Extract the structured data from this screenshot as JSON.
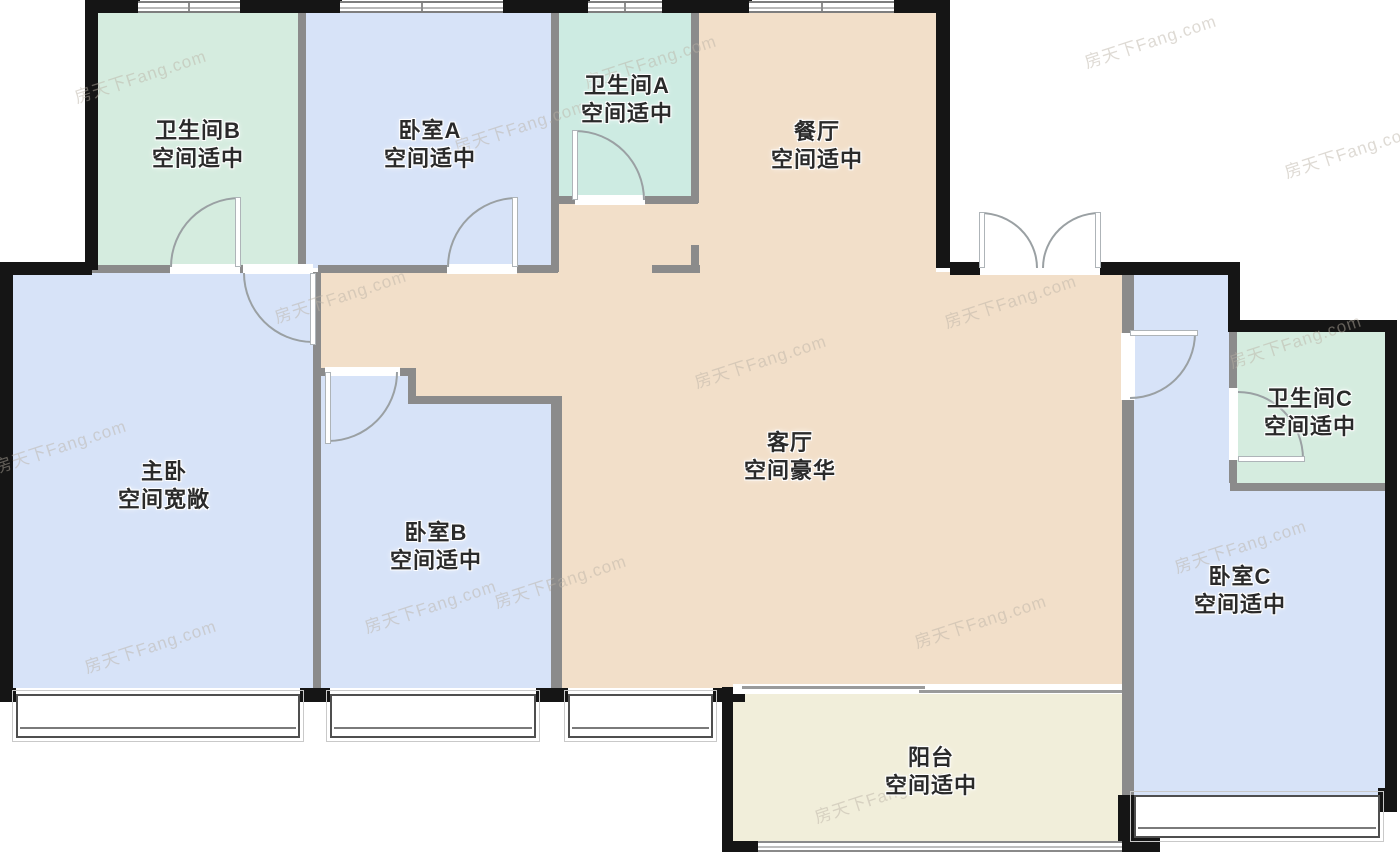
{
  "watermark_text": "房天下Fang.com",
  "colors": {
    "wall_black": "#151515",
    "wall_gray": "#8b8b8b",
    "bath_green": "#d5ecdf",
    "bath_green2": "#cdebe2",
    "bedroom_blue": "#d7e3f8",
    "living_tan": "#f2dfc9",
    "balcony_cream": "#f1eeda",
    "outside_white": "#ffffff"
  },
  "labels": [
    {
      "name": "bathroom-b-label",
      "line1": "卫生间B",
      "line2": "空间适中",
      "cx": 198,
      "cy": 145
    },
    {
      "name": "bedroom-a-label",
      "line1": "卧室A",
      "line2": "空间适中",
      "cx": 430,
      "cy": 145
    },
    {
      "name": "bathroom-a-label",
      "line1": "卫生间A",
      "line2": "空间适中",
      "cx": 627,
      "cy": 100
    },
    {
      "name": "dining-room-label",
      "line1": "餐厅",
      "line2": "空间适中",
      "cx": 817,
      "cy": 146
    },
    {
      "name": "master-bedroom-label",
      "line1": "主卧",
      "line2": "空间宽敞",
      "cx": 164,
      "cy": 486
    },
    {
      "name": "bedroom-b-label",
      "line1": "卧室B",
      "line2": "空间适中",
      "cx": 436,
      "cy": 547
    },
    {
      "name": "living-room-label",
      "line1": "客厅",
      "line2": "空间豪华",
      "cx": 790,
      "cy": 457
    },
    {
      "name": "bathroom-c-label",
      "line1": "卫生间C",
      "line2": "空间适中",
      "cx": 1310,
      "cy": 413
    },
    {
      "name": "bedroom-c-label",
      "line1": "卧室C",
      "line2": "空间适中",
      "cx": 1240,
      "cy": 591
    },
    {
      "name": "balcony-label",
      "line1": "阳台",
      "line2": "空间适中",
      "cx": 931,
      "cy": 772
    }
  ],
  "rooms": [
    {
      "name": "bathroom-b-floor",
      "x": 92,
      "y": 10,
      "w": 213,
      "h": 258,
      "fill": "bath_green"
    },
    {
      "name": "bedroom-a-floor",
      "x": 305,
      "y": 10,
      "w": 246,
      "h": 258,
      "fill": "bedroom_blue"
    },
    {
      "name": "bathroom-a-floor",
      "x": 551,
      "y": 10,
      "w": 147,
      "h": 190,
      "fill": "bath_green2"
    },
    {
      "name": "dining-floor",
      "x": 698,
      "y": 10,
      "w": 238,
      "h": 265,
      "fill": "living_tan"
    },
    {
      "name": "hall-top-floor",
      "x": 558,
      "y": 200,
      "w": 140,
      "h": 75,
      "fill": "living_tan"
    },
    {
      "name": "hall-floor",
      "x": 321,
      "y": 268,
      "w": 237,
      "h": 135,
      "fill": "living_tan"
    },
    {
      "name": "living-floor",
      "x": 558,
      "y": 272,
      "w": 564,
      "h": 416,
      "fill": "living_tan"
    },
    {
      "name": "master-bedroom-floor",
      "x": 13,
      "y": 273,
      "w": 300,
      "h": 415,
      "fill": "bedroom_blue"
    },
    {
      "name": "bedroom-b-notch-floor",
      "x": 321,
      "y": 372,
      "w": 87,
      "h": 31,
      "fill": "bedroom_blue"
    },
    {
      "name": "bedroom-b-floor",
      "x": 321,
      "y": 403,
      "w": 230,
      "h": 285,
      "fill": "bedroom_blue"
    },
    {
      "name": "balcony-floor",
      "x": 733,
      "y": 694,
      "w": 389,
      "h": 147,
      "fill": "balcony_cream"
    },
    {
      "name": "bedroom-c-floor",
      "x": 1134,
      "y": 275,
      "w": 96,
      "h": 520,
      "fill": "bedroom_blue"
    },
    {
      "name": "bedroom-c-floor-2",
      "x": 1230,
      "y": 490,
      "w": 155,
      "h": 305,
      "fill": "bedroom_blue"
    },
    {
      "name": "bathroom-c-floor",
      "x": 1237,
      "y": 332,
      "w": 148,
      "h": 151,
      "fill": "bath_green"
    }
  ],
  "walls_gray": [
    {
      "x": 92,
      "y": 265,
      "w": 78,
      "h": 8
    },
    {
      "x": 238,
      "y": 265,
      "w": 8,
      "h": 8
    },
    {
      "x": 318,
      "y": 265,
      "w": 129,
      "h": 8
    },
    {
      "x": 517,
      "y": 265,
      "w": 41,
      "h": 8
    },
    {
      "x": 551,
      "y": 196,
      "w": 24,
      "h": 8
    },
    {
      "x": 645,
      "y": 196,
      "w": 53,
      "h": 8
    },
    {
      "x": 652,
      "y": 265,
      "w": 48,
      "h": 8
    },
    {
      "x": 318,
      "y": 368,
      "w": 10,
      "h": 8
    },
    {
      "x": 396,
      "y": 368,
      "w": 19,
      "h": 8
    },
    {
      "x": 408,
      "y": 396,
      "w": 150,
      "h": 8
    },
    {
      "x": 1230,
      "y": 483,
      "w": 155,
      "h": 8
    },
    {
      "x": 298,
      "y": 10,
      "w": 8,
      "h": 262
    },
    {
      "x": 551,
      "y": 10,
      "w": 8,
      "h": 262
    },
    {
      "x": 691,
      "y": 10,
      "w": 8,
      "h": 193
    },
    {
      "x": 691,
      "y": 245,
      "w": 8,
      "h": 27
    },
    {
      "x": 313,
      "y": 272,
      "w": 8,
      "h": 418
    },
    {
      "x": 408,
      "y": 368,
      "w": 8,
      "h": 35
    },
    {
      "x": 551,
      "y": 396,
      "w": 11,
      "h": 294
    },
    {
      "x": 1122,
      "y": 275,
      "w": 12,
      "h": 58
    },
    {
      "x": 1122,
      "y": 400,
      "w": 12,
      "h": 443
    },
    {
      "x": 1229,
      "y": 332,
      "w": 8,
      "h": 56
    },
    {
      "x": 1229,
      "y": 460,
      "w": 8,
      "h": 23
    }
  ],
  "walls_black": [
    {
      "x": 85,
      "y": 0,
      "w": 13,
      "h": 270
    },
    {
      "x": 85,
      "y": 0,
      "w": 55,
      "h": 13
    },
    {
      "x": 240,
      "y": 0,
      "w": 102,
      "h": 13
    },
    {
      "x": 503,
      "y": 0,
      "w": 87,
      "h": 13
    },
    {
      "x": 662,
      "y": 0,
      "w": 90,
      "h": 13
    },
    {
      "x": 894,
      "y": 0,
      "w": 56,
      "h": 13
    },
    {
      "x": 936,
      "y": 0,
      "w": 14,
      "h": 268
    },
    {
      "x": 950,
      "y": 262,
      "w": 30,
      "h": 13
    },
    {
      "x": 1100,
      "y": 262,
      "w": 140,
      "h": 13
    },
    {
      "x": 1228,
      "y": 262,
      "w": 12,
      "h": 70
    },
    {
      "x": 1228,
      "y": 320,
      "w": 169,
      "h": 12
    },
    {
      "x": 1385,
      "y": 320,
      "w": 12,
      "h": 492
    },
    {
      "x": 0,
      "y": 262,
      "w": 92,
      "h": 13
    },
    {
      "x": 0,
      "y": 262,
      "w": 13,
      "h": 440
    },
    {
      "x": 0,
      "y": 688,
      "w": 16,
      "h": 14
    },
    {
      "x": 300,
      "y": 688,
      "w": 30,
      "h": 14
    },
    {
      "x": 536,
      "y": 688,
      "w": 32,
      "h": 14
    },
    {
      "x": 713,
      "y": 688,
      "w": 32,
      "h": 14
    },
    {
      "x": 722,
      "y": 687,
      "w": 11,
      "h": 165
    },
    {
      "x": 722,
      "y": 841,
      "w": 36,
      "h": 11
    },
    {
      "x": 1122,
      "y": 830,
      "w": 38,
      "h": 22
    },
    {
      "x": 1118,
      "y": 795,
      "w": 16,
      "h": 57
    },
    {
      "x": 1378,
      "y": 788,
      "w": 19,
      "h": 24
    }
  ],
  "windows_top": [
    {
      "name": "bathroom-b-window",
      "x": 138,
      "y": 1,
      "w": 102,
      "h": 12
    },
    {
      "name": "bedroom-a-window",
      "x": 340,
      "y": 1,
      "w": 163,
      "h": 12
    },
    {
      "name": "bathroom-a-window",
      "x": 588,
      "y": 1,
      "w": 74,
      "h": 12
    },
    {
      "name": "dining-window",
      "x": 749,
      "y": 1,
      "w": 145,
      "h": 12
    }
  ],
  "windows_bay": [
    {
      "name": "master-bedroom-window",
      "x": 16,
      "y": 694,
      "w": 284,
      "h": 44
    },
    {
      "name": "bedroom-b-window",
      "x": 330,
      "y": 694,
      "w": 206,
      "h": 44
    },
    {
      "name": "hall-window",
      "x": 568,
      "y": 694,
      "w": 145,
      "h": 44
    },
    {
      "name": "bedroom-c-window",
      "x": 1134,
      "y": 795,
      "w": 246,
      "h": 43
    }
  ],
  "balcony_rail": {
    "x": 758,
    "y": 841,
    "w": 364,
    "h": 11
  },
  "slider": {
    "band": {
      "x": 733,
      "y": 684,
      "w": 389,
      "h": 10
    },
    "line_a": {
      "x": 742,
      "y": 686,
      "w": 183,
      "h": 3
    },
    "line_b": {
      "x": 919,
      "y": 690,
      "w": 203,
      "h": 3
    }
  },
  "doors": [
    {
      "name": "bathroom-b-door",
      "arc": {
        "x": 170,
        "y": 197,
        "w": 70,
        "h": 70,
        "corner": "tl"
      },
      "leaf": {
        "x": 235,
        "y": 197,
        "w": 6,
        "h": 70
      },
      "thr": {
        "x": 170,
        "y": 264,
        "w": 70,
        "h": 10
      }
    },
    {
      "name": "master-bedroom-door",
      "arc": {
        "x": 243,
        "y": 273,
        "w": 70,
        "h": 70,
        "corner": "bl"
      },
      "leaf": {
        "x": 310,
        "y": 273,
        "w": 6,
        "h": 72
      },
      "thr": {
        "x": 243,
        "y": 264,
        "w": 70,
        "h": 10
      }
    },
    {
      "name": "bedroom-a-door",
      "arc": {
        "x": 447,
        "y": 197,
        "w": 70,
        "h": 70,
        "corner": "tl"
      },
      "leaf": {
        "x": 512,
        "y": 197,
        "w": 6,
        "h": 70
      },
      "thr": {
        "x": 447,
        "y": 264,
        "w": 70,
        "h": 10
      }
    },
    {
      "name": "bathroom-a-door",
      "arc": {
        "x": 575,
        "y": 130,
        "w": 70,
        "h": 70,
        "corner": "tr"
      },
      "leaf": {
        "x": 572,
        "y": 130,
        "w": 6,
        "h": 70
      },
      "thr": {
        "x": 575,
        "y": 195,
        "w": 70,
        "h": 10
      }
    },
    {
      "name": "bedroom-b-door",
      "arc": {
        "x": 328,
        "y": 372,
        "w": 70,
        "h": 70,
        "corner": "br"
      },
      "leaf": {
        "x": 325,
        "y": 372,
        "w": 6,
        "h": 72
      },
      "thr": {
        "x": 325,
        "y": 367,
        "w": 75,
        "h": 9
      }
    },
    {
      "name": "entry-door-left",
      "arc": {
        "x": 980,
        "y": 212,
        "w": 58,
        "h": 56,
        "corner": "tr"
      },
      "leaf": {
        "x": 979,
        "y": 212,
        "w": 6,
        "h": 56
      },
      "thr": {
        "x": 980,
        "y": 262,
        "w": 120,
        "h": 13
      }
    },
    {
      "name": "entry-door-right",
      "arc": {
        "x": 1042,
        "y": 212,
        "w": 58,
        "h": 56,
        "corner": "tl"
      },
      "leaf": {
        "x": 1095,
        "y": 212,
        "w": 6,
        "h": 56
      },
      "thr": null
    },
    {
      "name": "bedroom-c-door",
      "arc": {
        "x": 1130,
        "y": 333,
        "w": 66,
        "h": 66,
        "corner": "br"
      },
      "leaf": {
        "x": 1130,
        "y": 330,
        "w": 68,
        "h": 6
      },
      "thr": {
        "x": 1121,
        "y": 333,
        "w": 14,
        "h": 67
      }
    },
    {
      "name": "bathroom-c-door",
      "arc": {
        "x": 1238,
        "y": 391,
        "w": 66,
        "h": 68,
        "corner": "tr"
      },
      "leaf": {
        "x": 1238,
        "y": 456,
        "w": 67,
        "h": 6
      },
      "thr": {
        "x": 1229,
        "y": 388,
        "w": 9,
        "h": 72
      }
    }
  ],
  "watermarks": [
    {
      "x": 140,
      "y": 75
    },
    {
      "x": 650,
      "y": 60
    },
    {
      "x": 1150,
      "y": 40
    },
    {
      "x": 520,
      "y": 125
    },
    {
      "x": 60,
      "y": 445
    },
    {
      "x": 340,
      "y": 295
    },
    {
      "x": 760,
      "y": 360
    },
    {
      "x": 1010,
      "y": 300
    },
    {
      "x": 560,
      "y": 580
    },
    {
      "x": 430,
      "y": 605
    },
    {
      "x": 880,
      "y": 795
    },
    {
      "x": 1295,
      "y": 340
    },
    {
      "x": 1240,
      "y": 545
    },
    {
      "x": 150,
      "y": 645
    },
    {
      "x": 980,
      "y": 620
    },
    {
      "x": 1350,
      "y": 150
    }
  ]
}
